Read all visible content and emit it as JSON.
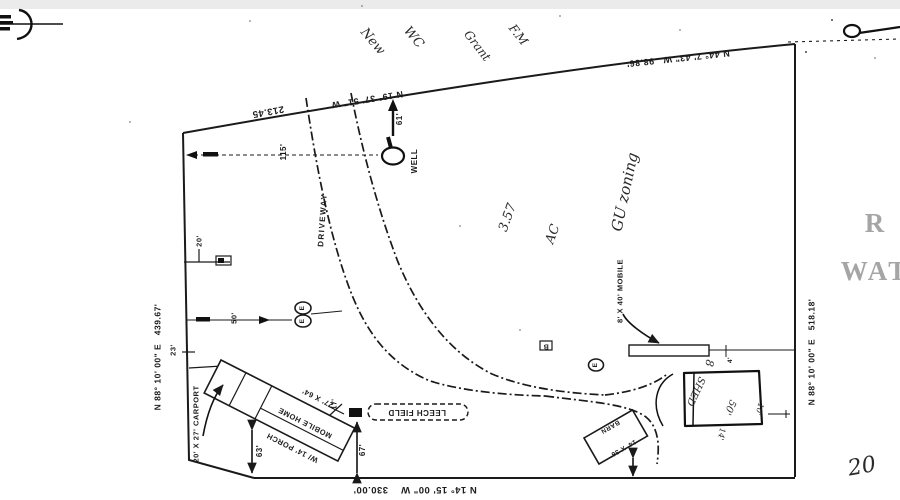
{
  "boundary": {
    "top_left_bearing": "N 19° 37' 51\" W",
    "top_left_distance": "213.45",
    "top_right": "N 44° 7' 43\" W   98.86'",
    "left": "N 88° 10' 00\" E   439.67'",
    "right": "N 88° 10' 00\" E   518.18'",
    "bottom": "N 14° 15' 00\" W    330.00'"
  },
  "features": {
    "well": "WELL",
    "driveway": "DRIVEWAY",
    "leech_field": "LEECH FIELD",
    "mobile_home_size": "27' X 64'",
    "mobile_home": "MOBILE HOME",
    "mobile_home_porch": "W/ 14' PORCH",
    "carport": "20' X 27' CARPORT",
    "mobile_8x40": "8' X 40' MOBILE",
    "barn_size": "14' X 36'",
    "barn": "BARN",
    "shed_size": "50'",
    "shed": "SHED",
    "marker_b": "B",
    "marker_e": "E"
  },
  "dimensions": {
    "well_offset": "61'",
    "well_line": "115'",
    "d20": "20'",
    "d50": "50'",
    "d17": "17'",
    "d23": "23'",
    "d63": "63'",
    "d67": "67'",
    "d10": "10'",
    "d14": "14'",
    "d4": "4'",
    "d8": "8"
  },
  "handwriting": {
    "note_1": "New",
    "note_2": "WC",
    "note_3": "Grant",
    "note_4": "F.M",
    "acreage": "3.57",
    "acreage_unit": "AC",
    "zoning": "GU zoning",
    "corner_note": "20"
  },
  "stamp": {
    "line_1": "R",
    "line_2": "WAT"
  }
}
